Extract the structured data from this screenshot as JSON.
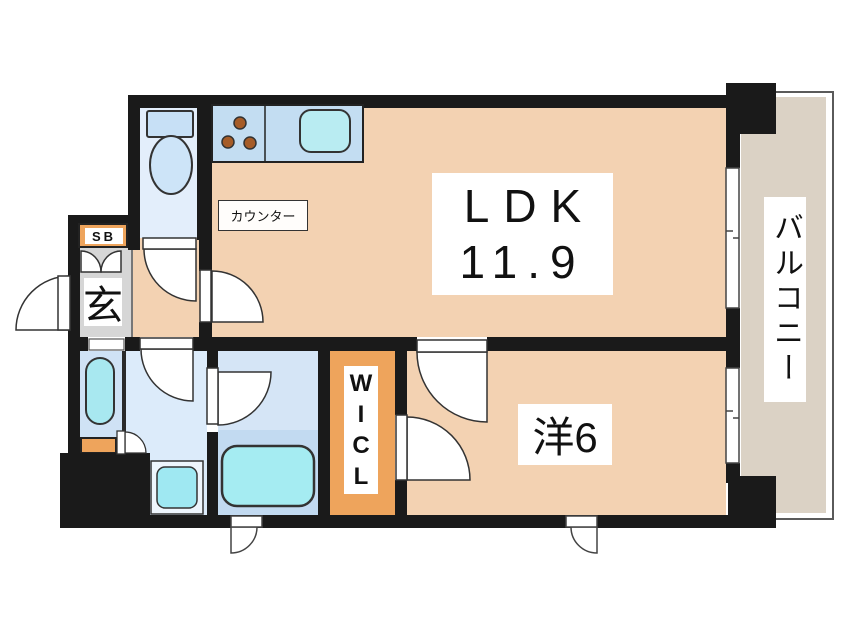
{
  "title": "1LDK apartment floor plan",
  "labels": {
    "ldk_name": "LDK",
    "ldk_size": "11.9",
    "western_room": "洋6",
    "wicl": [
      "W",
      "I",
      "C",
      "L"
    ],
    "balcony": "バルコニー",
    "counter": "カウンター",
    "shoe_box": "SB",
    "entrance": "玄"
  },
  "colors": {
    "wall": "#1a1a1a",
    "floor_peach": "#f3d2b2",
    "entry_gray": "#d6d6d6",
    "orange": "#eea45c",
    "balcony": "#dbd2c5",
    "toilet_floor": "#e3eefb",
    "washroom_floor": "#dcebfa",
    "laundry_floor": "#cfe2f5",
    "bathroom_floor": "#d5e5f6",
    "bathroom_lower": "#c2daf1",
    "kitchen_blue": "#c3ddf2",
    "fixture_cyan": "#a5ecf2",
    "burner_brown": "#a65c28"
  }
}
